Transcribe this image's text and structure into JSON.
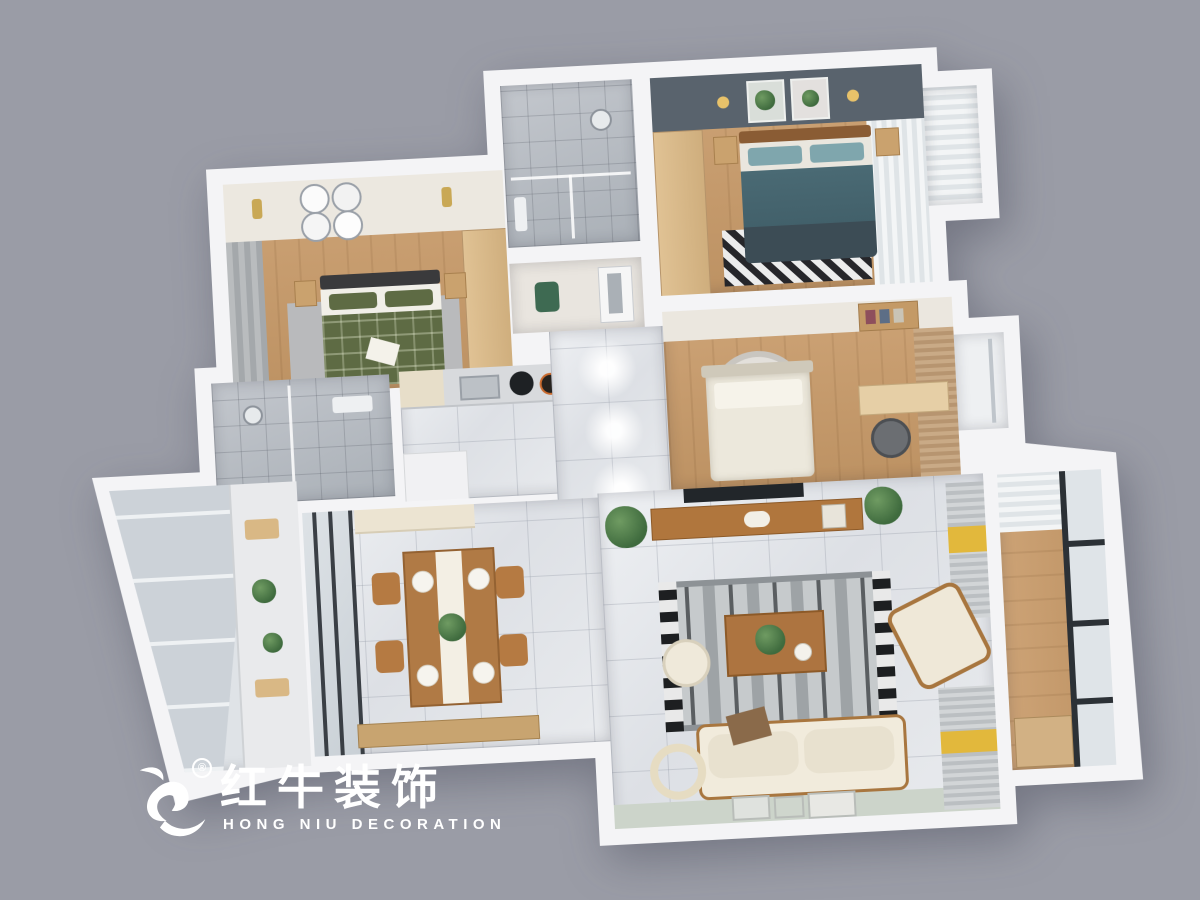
{
  "canvas": {
    "width": 1200,
    "height": 900,
    "background": "#9a9ca6"
  },
  "watermark": {
    "icon": "bull-icon",
    "registered_mark": "®",
    "brand_cn": "红牛装饰",
    "brand_en": "HONG NIU DECORATION",
    "color": "#ffffff"
  },
  "scene": {
    "type": "3d-apartment-floorplan-render",
    "view": "top-down",
    "rooms": [
      {
        "id": "bedroom-green",
        "label": "bedroom with green plaid bed",
        "floor": "wood",
        "features": [
          "gray-curtain-window",
          "ceiling-plate-art-2x2",
          "gold-sconces",
          "wood-wardrobe",
          "twin-nightstands",
          "gray-rug"
        ]
      },
      {
        "id": "shower-bathroom-top",
        "label": "shower room",
        "floor": "gray-tile",
        "features": [
          "glass-partition",
          "shower-head"
        ]
      },
      {
        "id": "hall-nook",
        "label": "hallway nook",
        "floor": "light",
        "features": [
          "green-chair",
          "interior-door"
        ]
      },
      {
        "id": "master-bedroom",
        "label": "master bedroom with teal bed",
        "floor": "wood",
        "features": [
          "slate-accent-wall",
          "botanical-art",
          "wall-sconces",
          "wood-wardrobe",
          "chevron-rug",
          "white-curtain-bay-window"
        ]
      },
      {
        "id": "shower-bathroom-mid",
        "label": "second shower room",
        "floor": "gray-tile",
        "features": [
          "glass-partition"
        ]
      },
      {
        "id": "kitchen",
        "label": "kitchen",
        "floor": "marble",
        "features": [
          "range-hood",
          "sink",
          "wok-cooktop",
          "counter"
        ]
      },
      {
        "id": "hallway",
        "label": "marble hallway",
        "floor": "marble",
        "features": [
          "ceiling-spotlights"
        ]
      },
      {
        "id": "study-bedroom",
        "label": "bedroom-study with white bed",
        "floor": "wood",
        "features": [
          "round-red-rug",
          "desk",
          "office-chair",
          "bookshelf",
          "tan-blinds",
          "bay-window"
        ]
      },
      {
        "id": "utility-balcony",
        "label": "glazed prep balcony",
        "floor": "tile",
        "features": [
          "full-height-windows",
          "prep-counter",
          "plants",
          "cutting-board"
        ]
      },
      {
        "id": "dining-room",
        "label": "dining room",
        "floor": "marble",
        "features": [
          "wood-table-for-four",
          "white-table-runner",
          "plant-centerpiece",
          "dark-frame-sliding-door",
          "sideboard"
        ]
      },
      {
        "id": "living-room",
        "label": "living room",
        "floor": "marble",
        "features": [
          "tv-console",
          "wall-tv",
          "patterned-rug",
          "cream-sofa",
          "armchair",
          "coffee-table",
          "pouf",
          "ring-floor-lamp",
          "window-bench-yellow-throws",
          "leaning-art-frames",
          "plants"
        ]
      },
      {
        "id": "balcony",
        "label": "balcony",
        "floor": "wood",
        "features": [
          "black-frame-glazing",
          "white-curtain"
        ]
      }
    ]
  },
  "palette": {
    "background": "#9a9ca6",
    "wall": "#f4f4f6",
    "wood_floor": "#c49a6c",
    "marble": "#e4e6e9",
    "bath_tile": "#b8bcc2",
    "slate_wall": "#59636d",
    "teal_bed": "#41626b",
    "green_bed": "#5e6b44",
    "cream": "#efe9dc",
    "accent_yellow": "#e2b83c",
    "rug_red": "#b2605a",
    "frame_black": "#2c3136",
    "chair_wood": "#b57a42",
    "sage_floor": "#ccd4ca"
  }
}
